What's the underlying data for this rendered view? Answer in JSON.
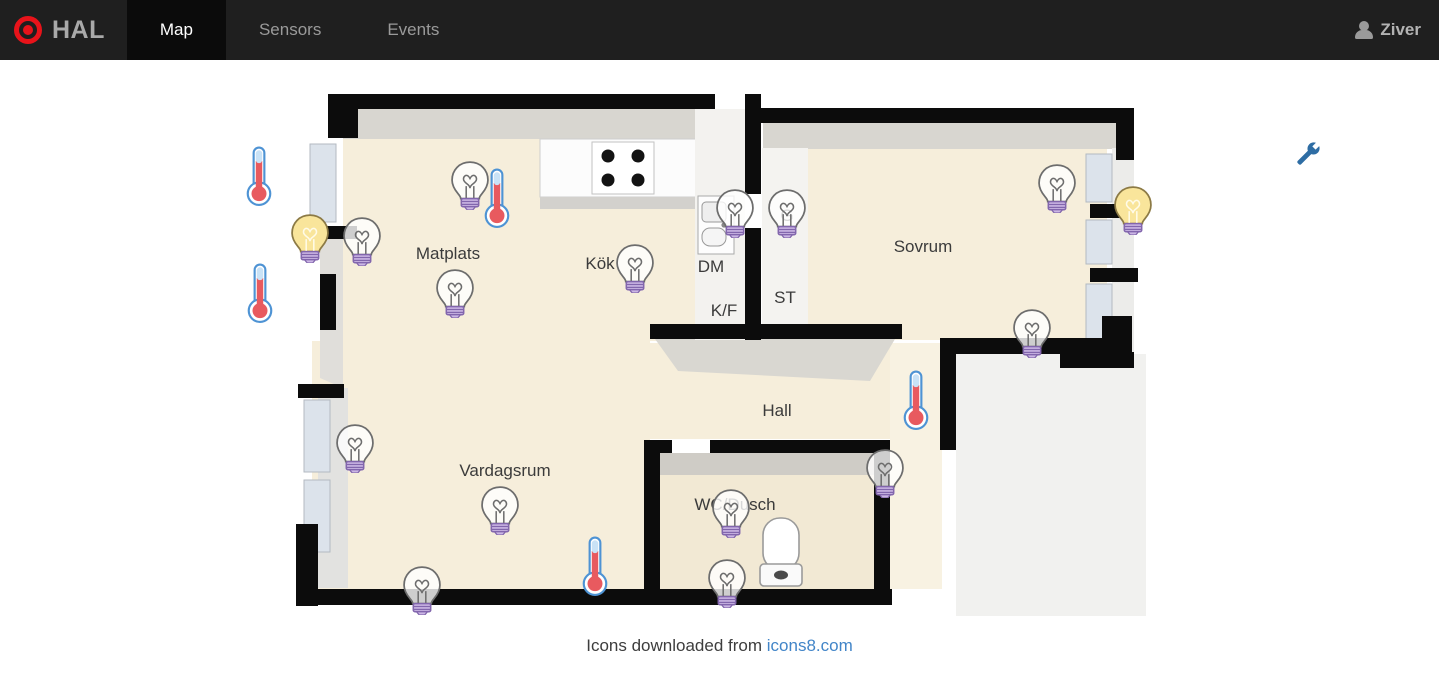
{
  "navbar": {
    "brand": "HAL",
    "tabs": [
      {
        "label": "Map",
        "active": true
      },
      {
        "label": "Sensors",
        "active": false
      },
      {
        "label": "Events",
        "active": false
      }
    ],
    "user": "Ziver"
  },
  "icons": {
    "logo": "target-icon",
    "user": "user-icon",
    "settings": "wrench-icon",
    "bulb_on": "lightbulb-on-icon",
    "bulb_off": "lightbulb-off-icon",
    "thermometer": "thermometer-icon"
  },
  "colors": {
    "navbar_bg": "#1f1f1f",
    "active_tab_bg": "#0b0b0b",
    "accent_red": "#e8131a",
    "wrench_blue": "#2e6da4",
    "link_blue": "#4285c8",
    "bulb_on_yellow": "#f9e59b",
    "bulb_base_purple": "#cbb6e4",
    "thermometer_red": "#e85a5f",
    "floor_beige": "#f6eedb"
  },
  "map": {
    "rooms": [
      {
        "label": "Matplats",
        "x": 208,
        "y": 166
      },
      {
        "label": "Kök",
        "x": 360,
        "y": 176
      },
      {
        "label": "DM",
        "x": 471,
        "y": 179
      },
      {
        "label": "K/F",
        "x": 484,
        "y": 223
      },
      {
        "label": "G",
        "x": 547,
        "y": 128
      },
      {
        "label": "ST",
        "x": 545,
        "y": 210
      },
      {
        "label": "Sovrum",
        "x": 683,
        "y": 159
      },
      {
        "label": "Hall",
        "x": 537,
        "y": 323
      },
      {
        "label": "Vardagsrum",
        "x": 265,
        "y": 383
      },
      {
        "label": "WC/Dusch",
        "x": 495,
        "y": 417
      }
    ],
    "sensors": [
      {
        "id": 1,
        "type": "bulb",
        "state": "on",
        "x": 70,
        "y": 150
      },
      {
        "id": 2,
        "type": "bulb",
        "state": "off",
        "x": 122,
        "y": 153
      },
      {
        "id": 3,
        "type": "bulb",
        "state": "off",
        "x": 230,
        "y": 97
      },
      {
        "id": 4,
        "type": "bulb",
        "state": "off",
        "x": 215,
        "y": 205
      },
      {
        "id": 5,
        "type": "bulb",
        "state": "off",
        "x": 395,
        "y": 180
      },
      {
        "id": 6,
        "type": "bulb",
        "state": "off",
        "x": 495,
        "y": 125
      },
      {
        "id": 7,
        "type": "bulb",
        "state": "off",
        "x": 547,
        "y": 125
      },
      {
        "id": 8,
        "type": "bulb",
        "state": "off",
        "x": 817,
        "y": 100
      },
      {
        "id": 9,
        "type": "bulb",
        "state": "on",
        "x": 893,
        "y": 122
      },
      {
        "id": 10,
        "type": "bulb",
        "state": "off",
        "x": 792,
        "y": 245
      },
      {
        "id": 11,
        "type": "bulb",
        "state": "off",
        "x": 115,
        "y": 360
      },
      {
        "id": 12,
        "type": "bulb",
        "state": "off",
        "x": 260,
        "y": 422
      },
      {
        "id": 13,
        "type": "bulb",
        "state": "off",
        "x": 182,
        "y": 502
      },
      {
        "id": 14,
        "type": "bulb",
        "state": "off",
        "x": 645,
        "y": 385
      },
      {
        "id": 15,
        "type": "bulb",
        "state": "off",
        "x": 491,
        "y": 425
      },
      {
        "id": 16,
        "type": "bulb",
        "state": "off",
        "x": 487,
        "y": 495
      },
      {
        "id": 17,
        "type": "thermometer",
        "x": 19,
        "y": 88
      },
      {
        "id": 18,
        "type": "thermometer",
        "x": 20,
        "y": 205
      },
      {
        "id": 19,
        "type": "thermometer",
        "x": 257,
        "y": 110
      },
      {
        "id": 20,
        "type": "thermometer",
        "x": 676,
        "y": 312
      },
      {
        "id": 21,
        "type": "thermometer",
        "x": 355,
        "y": 478
      }
    ]
  },
  "footer": {
    "caption": "Icons downloaded from",
    "link": "icons8.com"
  }
}
